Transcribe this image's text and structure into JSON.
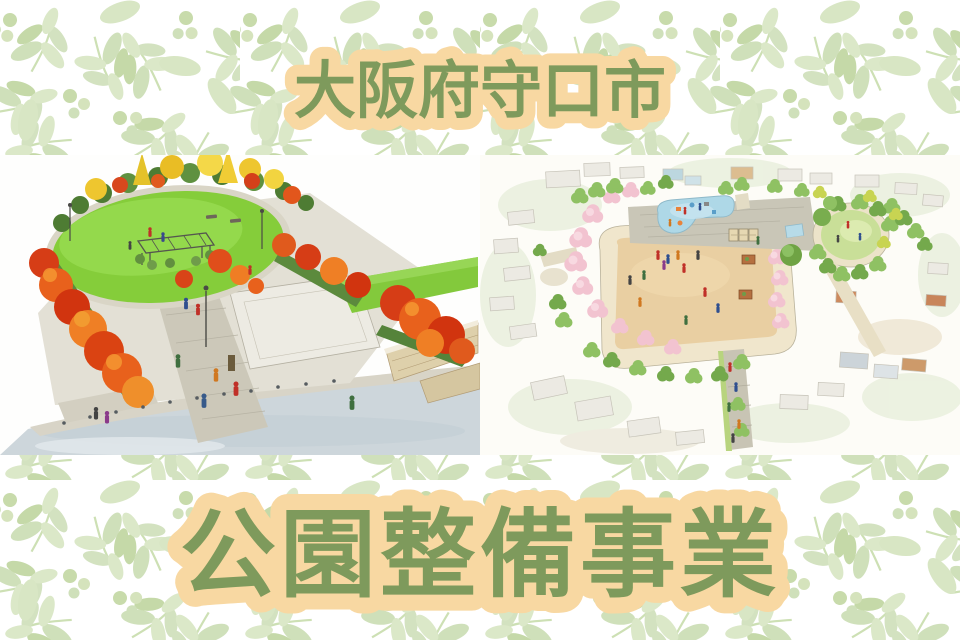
{
  "banner": {
    "top_title": "大阪府守口市",
    "bottom_title": "公園整備事業",
    "title_color": "#7e9a5c",
    "title_outline_color": "#f8d8a2"
  },
  "background": {
    "base_color": "#ffffff",
    "leaf_pattern_colors": [
      "#cfe0ba",
      "#dbe8c8",
      "#c5d9a8"
    ]
  },
  "illustrations": {
    "left": {
      "alt": "Watercolor perspective rendering of an autumn park with oval lawn, red maple and yellow ginkgo trees, brick promenade, pergola and visitors beside a road"
    },
    "right": {
      "alt": "Watercolor aerial rendering of a park block with a large sand plaza, water play pond, circular lawn, cherry blossom trees and surrounding houses"
    }
  }
}
